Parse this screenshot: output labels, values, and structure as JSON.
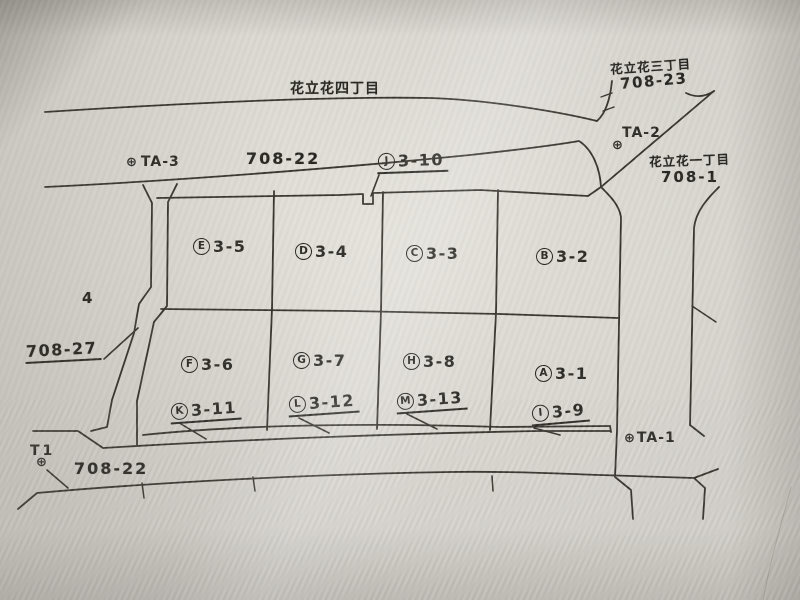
{
  "districts": {
    "north": "花立花四丁目",
    "northeast": "花立花三丁目",
    "northeast_lot": "708-23",
    "east": "花立花一丁目",
    "east_lot": "708-1"
  },
  "lots": {
    "north_road": "708-22",
    "west_block": "4",
    "west": "708-27",
    "south_road": "708-22"
  },
  "benchmarks": {
    "symbol": "⊕",
    "ta1": "TA-1",
    "ta2": "TA-2",
    "ta3": "TA-3",
    "t1": "T1"
  },
  "parcels": {
    "a": {
      "letter": "A",
      "number": "3-1"
    },
    "b": {
      "letter": "B",
      "number": "3-2"
    },
    "c": {
      "letter": "C",
      "number": "3-3"
    },
    "d": {
      "letter": "D",
      "number": "3-4"
    },
    "e": {
      "letter": "E",
      "number": "3-5"
    },
    "f": {
      "letter": "F",
      "number": "3-6"
    },
    "g": {
      "letter": "G",
      "number": "3-7"
    },
    "h": {
      "letter": "H",
      "number": "3-8"
    },
    "i": {
      "letter": "I",
      "number": "3-9"
    },
    "j": {
      "letter": "J",
      "number": "3-10"
    },
    "k": {
      "letter": "K",
      "number": "3-11"
    },
    "l": {
      "letter": "L",
      "number": "3-12"
    },
    "m": {
      "letter": "M",
      "number": "3-13"
    }
  },
  "colors": {
    "ink": "#36332d",
    "paper": "#d8d5cf"
  }
}
